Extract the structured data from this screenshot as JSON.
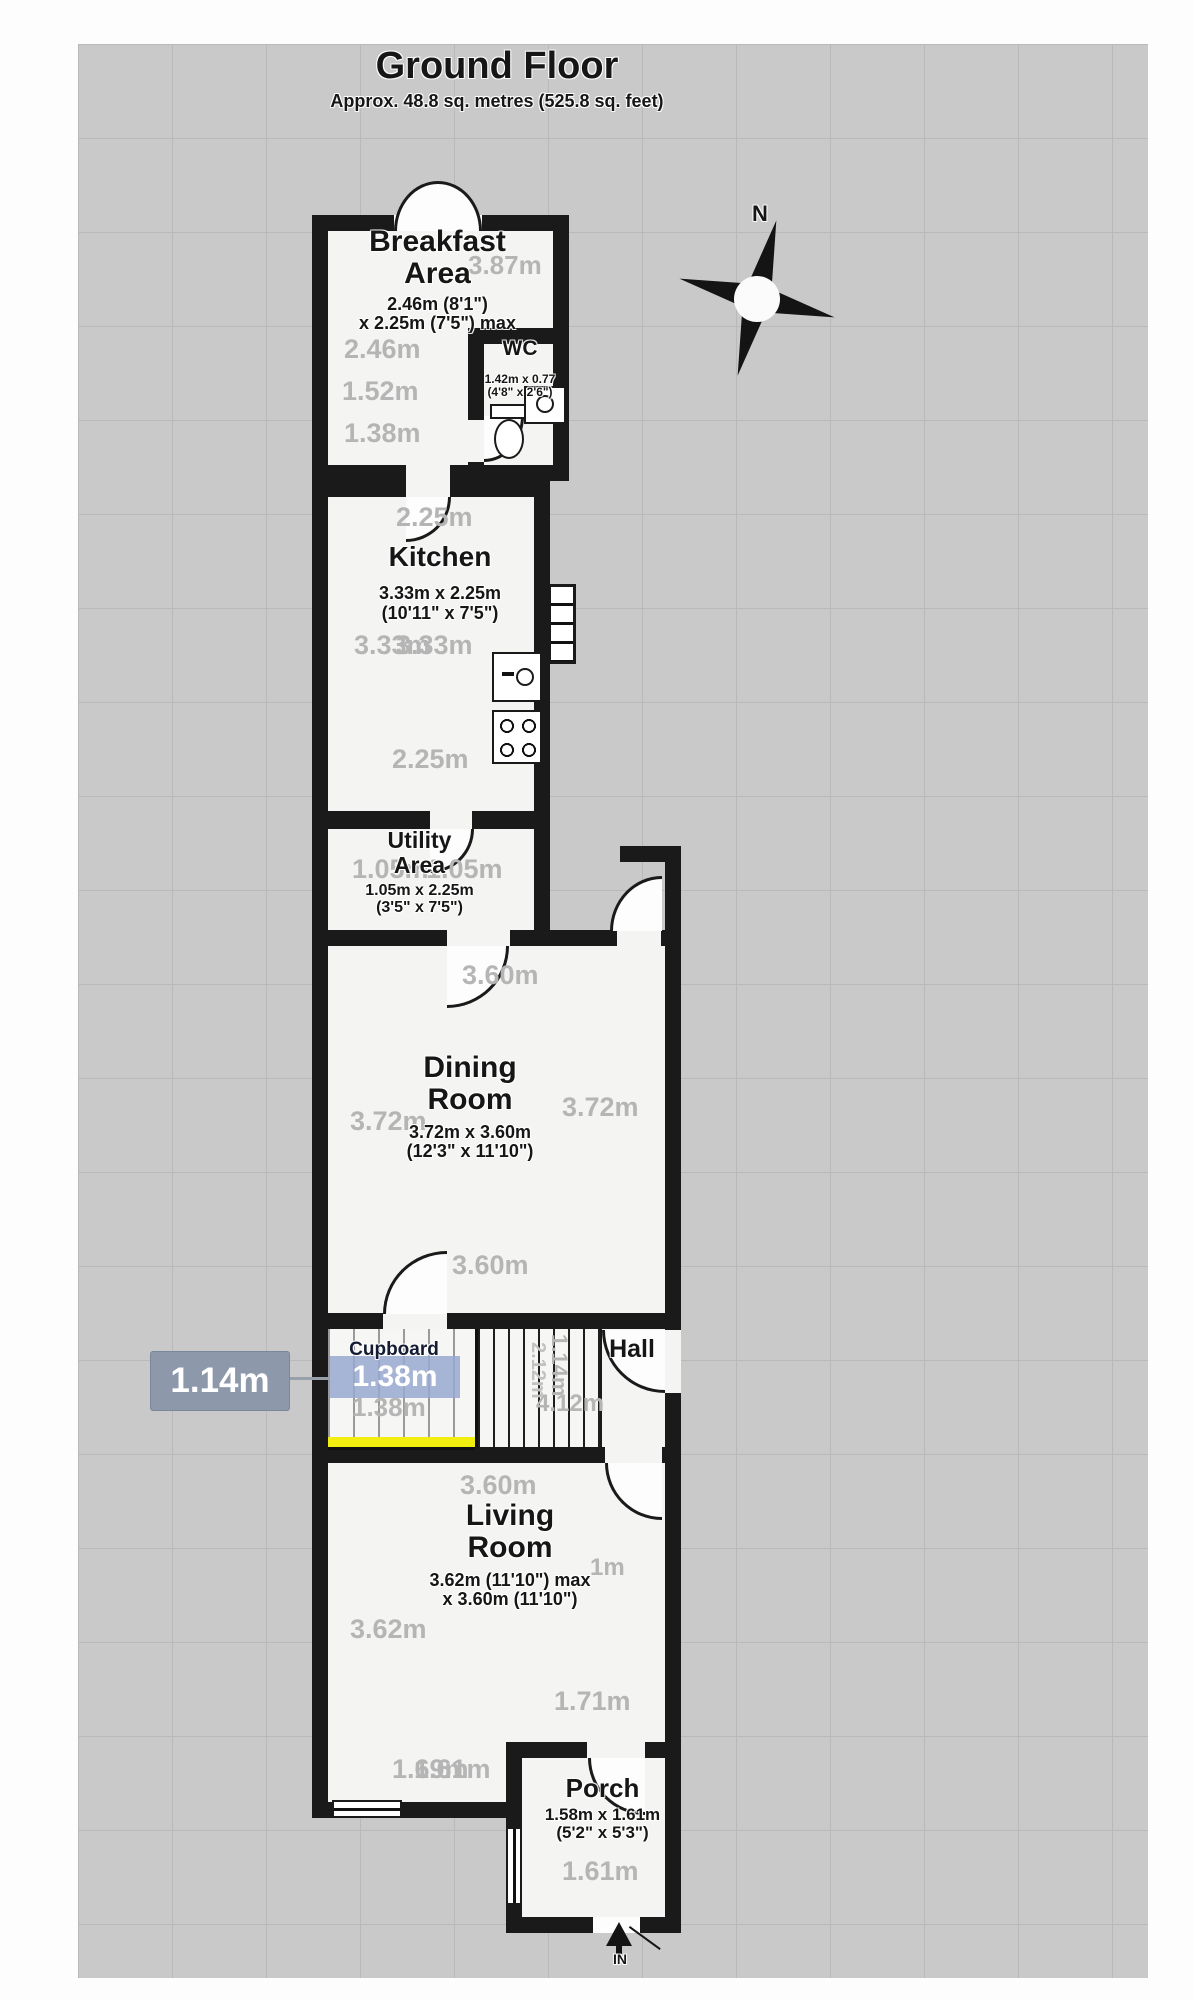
{
  "title": {
    "text": "Ground Floor",
    "subtitle": "Approx. 48.8 sq. metres (525.8 sq. feet)"
  },
  "compass": {
    "label": "N"
  },
  "rooms": {
    "breakfast": {
      "line1": "Breakfast",
      "line2": "Area",
      "dim1": "2.46m (8'1\")",
      "dim2": "x 2.25m (7'5\") max"
    },
    "wc": {
      "name": "WC",
      "dim1": "1.42m x 0.77",
      "dim2": "(4'8\" x 2'6\")"
    },
    "kitchen": {
      "name": "Kitchen",
      "dim1": "3.33m x 2.25m",
      "dim2": "(10'11\" x 7'5\")"
    },
    "utility": {
      "line1": "Utility",
      "line2": "Area",
      "dim1": "1.05m x 2.25m",
      "dim2": "(3'5\" x 7'5\")"
    },
    "dining": {
      "line1": "Dining",
      "line2": "Room",
      "dim1": "3.72m x 3.60m",
      "dim2": "(12'3\" x 11'10\")"
    },
    "hall": {
      "name": "Hall"
    },
    "cupboard": {
      "name": "Cupboard"
    },
    "living": {
      "line1": "Living",
      "line2": "Room",
      "dim1": "3.62m (11'10\") max",
      "dim2": "x 3.60m (11'10\")"
    },
    "porch": {
      "name": "Porch",
      "dim1": "1.58m x 1.61m",
      "dim2": "(5'2\" x 5'3\")"
    }
  },
  "entrance": {
    "label": "IN"
  },
  "selection": {
    "value": "1.14m",
    "cupboard_width": "1.38m",
    "cupboard_width_gray": "1.38m",
    "box_color": "#8d99ab",
    "highlight_color": "#98a8d0",
    "underline_color": "#f2ef10"
  },
  "gray_dims": [
    {
      "text": "3.87m"
    },
    {
      "text": "2.46m"
    },
    {
      "text": "1.52m"
    },
    {
      "text": "1.38m"
    },
    {
      "text": "2.25m"
    },
    {
      "text": "3.33m"
    },
    {
      "text": "3.33m"
    },
    {
      "text": "2.25m"
    },
    {
      "text": "1.05m"
    },
    {
      "text": "1.05m"
    },
    {
      "text": "3.60m"
    },
    {
      "text": "3.72m"
    },
    {
      "text": "3.72m"
    },
    {
      "text": "3.60m"
    },
    {
      "text": "4.12m"
    },
    {
      "text": "1.14m"
    },
    {
      "text": "2.12m"
    },
    {
      "text": "3.60m"
    },
    {
      "text": "3.62m"
    },
    {
      "text": "1m"
    },
    {
      "text": "1.71m"
    },
    {
      "text": "1.69m"
    },
    {
      "text": "1.61m"
    },
    {
      "text": "1.61m"
    },
    {
      "text": "1.38m"
    }
  ]
}
